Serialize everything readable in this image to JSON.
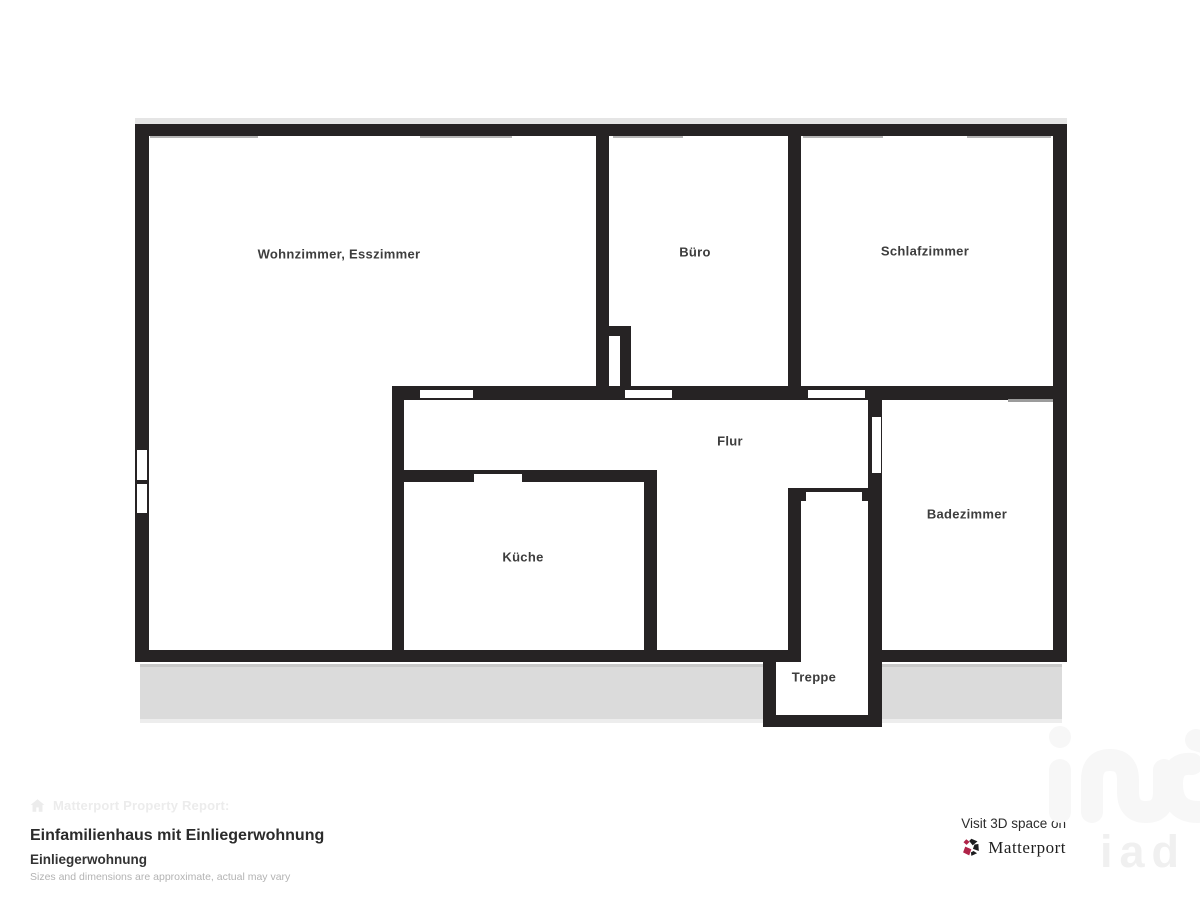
{
  "colors": {
    "wall": "#262324",
    "white": "#ffffff",
    "shadow": "#e5e5e5",
    "terrace": "#dbdbdb",
    "terrace_edge": "#ededed",
    "terrace_edge_dark": "#c9c9c9",
    "window_line": "#b5b5b5",
    "window_line_dark": "#9c9c9c",
    "label": "#3d3d3d",
    "brand_crimson": "#b02348",
    "brand_dark": "#1c1c1e"
  },
  "plan": {
    "rects": [
      {
        "name": "plan-top-shadow",
        "x": 135,
        "y": 118,
        "w": 932,
        "h": 6,
        "fill": "shadow"
      },
      {
        "name": "terrace-edge-top",
        "x": 140,
        "y": 664,
        "w": 922,
        "h": 3,
        "fill": "terrace_edge_dark"
      },
      {
        "name": "terrace-strip",
        "x": 140,
        "y": 667,
        "w": 922,
        "h": 52,
        "fill": "terrace"
      },
      {
        "name": "terrace-edge-bottom",
        "x": 140,
        "y": 719,
        "w": 922,
        "h": 4,
        "fill": "terrace_edge"
      },
      {
        "name": "treppe-interior",
        "x": 776,
        "y": 662,
        "w": 92,
        "h": 53,
        "fill": "white"
      },
      {
        "name": "wall-top",
        "x": 135,
        "y": 124,
        "w": 932,
        "h": 12,
        "fill": "wall"
      },
      {
        "name": "wall-left",
        "x": 135,
        "y": 124,
        "w": 14,
        "h": 538,
        "fill": "wall"
      },
      {
        "name": "wall-right",
        "x": 1053,
        "y": 124,
        "w": 14,
        "h": 538,
        "fill": "wall"
      },
      {
        "name": "wall-bottom-left",
        "x": 135,
        "y": 650,
        "w": 665,
        "h": 12,
        "fill": "wall"
      },
      {
        "name": "wall-bottom-right",
        "x": 868,
        "y": 650,
        "w": 199,
        "h": 12,
        "fill": "wall"
      },
      {
        "name": "wall-wohnzimmer-buero",
        "x": 596,
        "y": 136,
        "w": 13,
        "h": 252,
        "fill": "wall"
      },
      {
        "name": "wall-niche-cap",
        "x": 596,
        "y": 326,
        "w": 35,
        "h": 10,
        "fill": "wall"
      },
      {
        "name": "wall-niche-prong",
        "x": 620,
        "y": 336,
        "w": 11,
        "h": 52,
        "fill": "wall"
      },
      {
        "name": "wall-buero-schlafzimmer",
        "x": 788,
        "y": 136,
        "w": 13,
        "h": 264,
        "fill": "wall"
      },
      {
        "name": "wall-flur-top",
        "x": 392,
        "y": 386,
        "w": 675,
        "h": 14,
        "fill": "wall"
      },
      {
        "name": "wall-flur-left",
        "x": 392,
        "y": 398,
        "w": 12,
        "h": 254,
        "fill": "wall"
      },
      {
        "name": "wall-kueche-top",
        "x": 392,
        "y": 470,
        "w": 265,
        "h": 12,
        "fill": "wall"
      },
      {
        "name": "wall-kueche-right",
        "x": 644,
        "y": 470,
        "w": 13,
        "h": 182,
        "fill": "wall"
      },
      {
        "name": "wall-flur-badezimmer",
        "x": 868,
        "y": 400,
        "w": 14,
        "h": 327,
        "fill": "wall"
      },
      {
        "name": "wall-treppe-left",
        "x": 788,
        "y": 488,
        "w": 13,
        "h": 174,
        "fill": "wall"
      },
      {
        "name": "wall-treppe-door",
        "x": 788,
        "y": 488,
        "w": 94,
        "h": 13,
        "fill": "wall"
      },
      {
        "name": "wall-treppe-lower-left",
        "x": 763,
        "y": 650,
        "w": 13,
        "h": 77,
        "fill": "wall"
      },
      {
        "name": "wall-treppe-bottom",
        "x": 763,
        "y": 715,
        "w": 119,
        "h": 12,
        "fill": "wall"
      },
      {
        "name": "door-wohnzimmer",
        "x": 420,
        "y": 390,
        "w": 53,
        "h": 8,
        "fill": "white"
      },
      {
        "name": "door-buero",
        "x": 625,
        "y": 390,
        "w": 47,
        "h": 8,
        "fill": "white"
      },
      {
        "name": "door-schlafzimmer",
        "x": 808,
        "y": 390,
        "w": 57,
        "h": 8,
        "fill": "white"
      },
      {
        "name": "door-kueche",
        "x": 474,
        "y": 474,
        "w": 48,
        "h": 8,
        "fill": "white"
      },
      {
        "name": "door-badezimmer",
        "x": 872,
        "y": 417,
        "w": 9,
        "h": 56,
        "fill": "white"
      },
      {
        "name": "door-treppe",
        "x": 806,
        "y": 492,
        "w": 56,
        "h": 9,
        "fill": "white"
      },
      {
        "name": "window-left-upper",
        "x": 137,
        "y": 450,
        "w": 10,
        "h": 30,
        "fill": "white"
      },
      {
        "name": "window-left-lower",
        "x": 137,
        "y": 484,
        "w": 10,
        "h": 29,
        "fill": "white"
      },
      {
        "name": "window-top-1",
        "x": 150,
        "y": 136,
        "w": 108,
        "h": 2,
        "fill": "window_line"
      },
      {
        "name": "window-top-2",
        "x": 420,
        "y": 136,
        "w": 92,
        "h": 2,
        "fill": "window_line"
      },
      {
        "name": "window-top-3",
        "x": 613,
        "y": 136,
        "w": 70,
        "h": 2,
        "fill": "window_line"
      },
      {
        "name": "window-top-4",
        "x": 803,
        "y": 136,
        "w": 80,
        "h": 2,
        "fill": "window_line"
      },
      {
        "name": "window-top-5",
        "x": 967,
        "y": 136,
        "w": 84,
        "h": 2,
        "fill": "window_line"
      },
      {
        "name": "window-badezimmer-top",
        "x": 1008,
        "y": 399,
        "w": 45,
        "h": 3,
        "fill": "window_line_dark"
      }
    ],
    "rooms": [
      {
        "name": "wohnzimmer-esszimmer",
        "label": "Wohnzimmer, Esszimmer",
        "x": 339,
        "y": 254
      },
      {
        "name": "buero",
        "label": "Büro",
        "x": 695,
        "y": 252
      },
      {
        "name": "schlafzimmer",
        "label": "Schlafzimmer",
        "x": 925,
        "y": 251
      },
      {
        "name": "flur",
        "label": "Flur",
        "x": 730,
        "y": 441
      },
      {
        "name": "kueche",
        "label": "Küche",
        "x": 523,
        "y": 557
      },
      {
        "name": "badezimmer",
        "label": "Badezimmer",
        "x": 967,
        "y": 514
      },
      {
        "name": "treppe",
        "label": "Treppe",
        "x": 814,
        "y": 677
      }
    ]
  },
  "footer": {
    "report_label": "Matterport Property Report:",
    "title": "Einfamilienhaus mit Einliegerwohnung",
    "subtitle": "Einliegerwohnung",
    "disclaimer": "Sizes and dimensions are approximate, actual may vary",
    "visit_label": "Visit 3D space on",
    "brand": "Matterport"
  },
  "watermark": {
    "text": "iad"
  }
}
